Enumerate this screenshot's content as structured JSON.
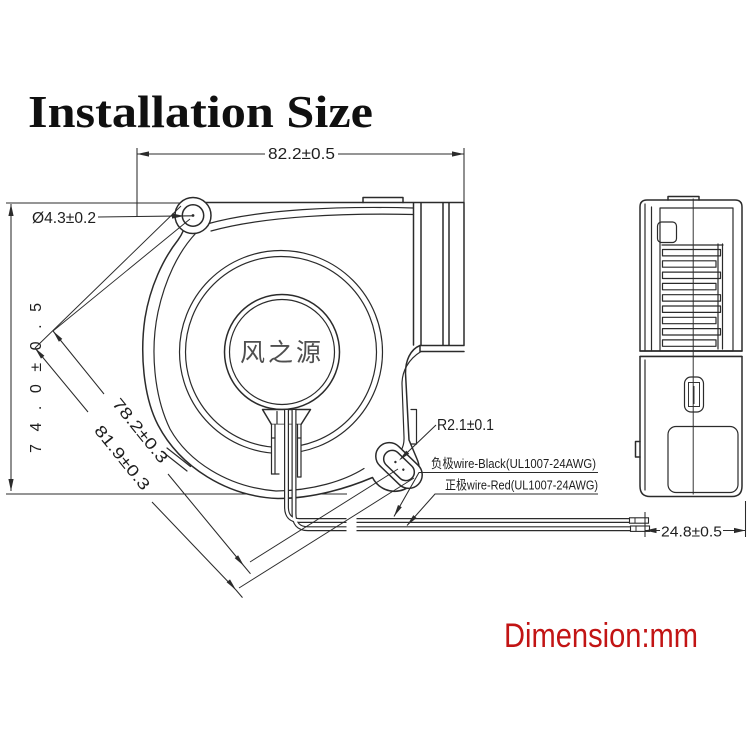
{
  "title": "Installation Size",
  "unit_note": "Dimension:mm",
  "front_view": {
    "hub_label": "风之源",
    "dim_width": "82.2±0.5",
    "dim_height": "74.0±0.5",
    "dim_hole": "Ø4.3±0.2",
    "dim_diag_inner": "78.2±0.3",
    "dim_diag_outer": "81.9±0.3",
    "dim_slot_radius": "R2.1±0.1",
    "wire_negative": "负极wire-Black(UL1007-24AWG)",
    "wire_positive": "正极wire-Red(UL1007-24AWG)"
  },
  "side_view": {
    "dim_depth": "24.8±0.5"
  },
  "colors": {
    "line": "#2b2b2b",
    "accent_red": "#c21414",
    "hub_text": "#4f4f4f"
  }
}
